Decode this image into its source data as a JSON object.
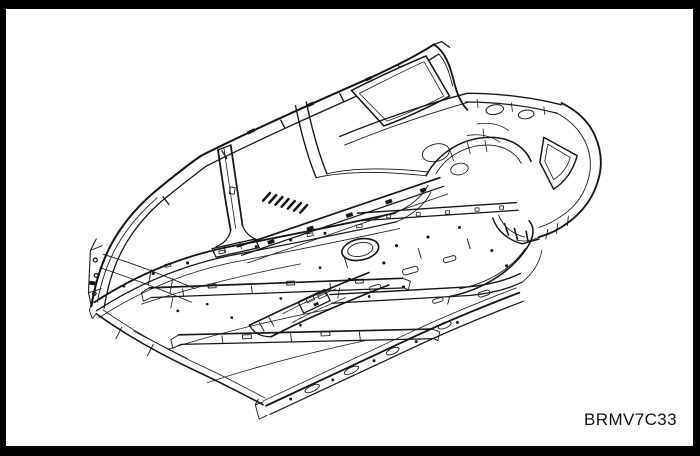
{
  "figure": {
    "code_label": "BRMV7C33",
    "illustration_alt": "Isometric technical line drawing of a vehicle body-in-white: side frame with A, B and C pillars, floor pan with cross members and tunnel, rear floor with circular access hole, rear wheel houses, package tray and rear panel",
    "colors": {
      "bg": "#ffffff",
      "frame": "#000000",
      "line": "#161616"
    },
    "parts": [
      "a-pillar",
      "roof-side-rail",
      "b-pillar",
      "c-pillar",
      "quarter-window-opening",
      "package-tray",
      "rear-panel",
      "near-sill",
      "far-rocker",
      "front-floor",
      "cross-members",
      "floor-tunnel",
      "rear-floor",
      "access-hole",
      "wheel-houses"
    ]
  }
}
